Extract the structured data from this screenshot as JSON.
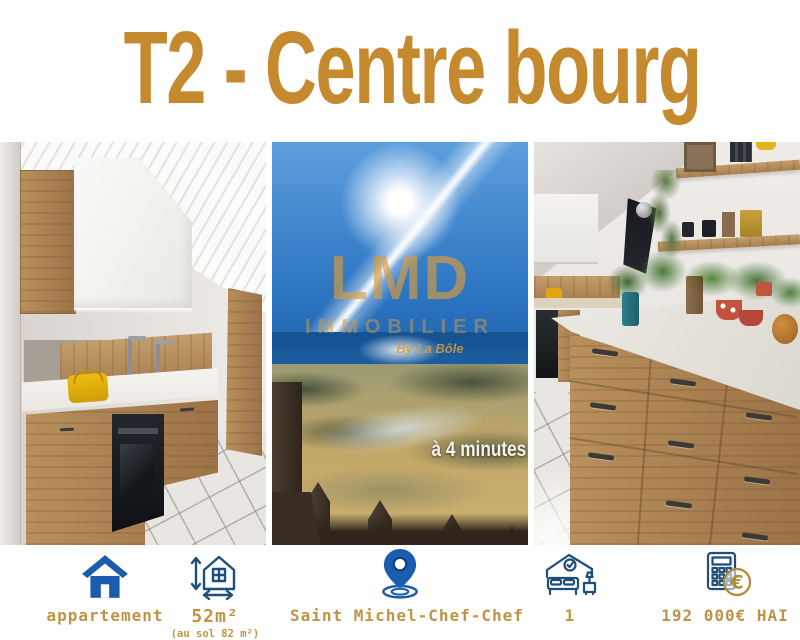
{
  "title": "T2 - Centre bourg",
  "colors": {
    "title_gold": "#c5892e",
    "label_gold": "#bf9445",
    "icon_blue": "#1a5cad",
    "icon_navy": "#1f4e79",
    "euro_gold": "#b08a37"
  },
  "photos": {
    "center": {
      "watermark": {
        "line1": "LMD",
        "line2": "IMMOBILIER",
        "line3": "By La Bôle"
      },
      "caption": "à 4 minutes de la plage à byciceltte"
    }
  },
  "footer": {
    "items": [
      {
        "icon": "house-icon",
        "label": "appartement"
      },
      {
        "icon": "house-dimensions-icon",
        "label": "52m²",
        "sublabel": "(au sol 82 m²)"
      },
      {
        "icon": "location-pin-icon",
        "label": "Saint Michel-Chef-Chef"
      },
      {
        "icon": "bedroom-icon",
        "label": "1"
      },
      {
        "icon": "calculator-euro-icon",
        "label": "192 000€ HAI"
      }
    ]
  }
}
